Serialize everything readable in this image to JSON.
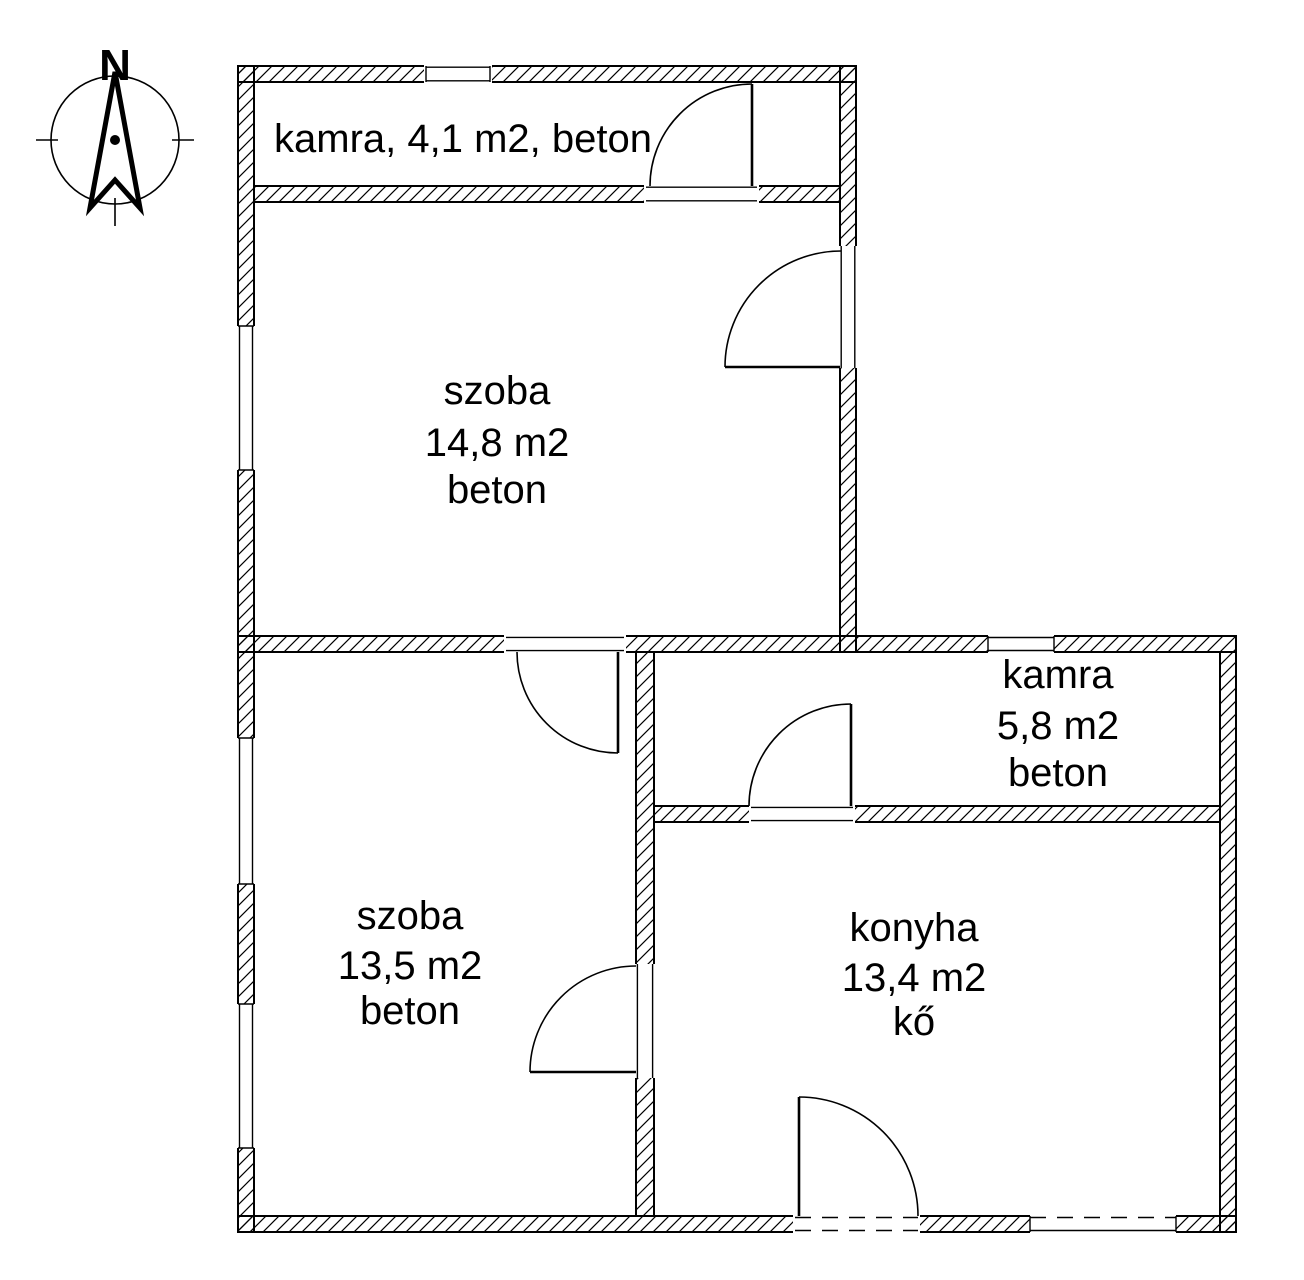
{
  "compass": {
    "north_label": "N"
  },
  "rooms": {
    "kamra_top": {
      "label": "kamra, 4,1 m2, beton"
    },
    "szoba_top": {
      "name": "szoba",
      "area": "14,8 m2",
      "floor": "beton"
    },
    "kamra_right": {
      "name": "kamra",
      "area": "5,8 m2",
      "floor": "beton"
    },
    "szoba_bottom": {
      "name": "szoba",
      "area": "13,5 m2",
      "floor": "beton"
    },
    "konyha": {
      "name": "konyha",
      "area": "13,4 m2",
      "floor": "kő"
    }
  },
  "colors": {
    "line": "#000000",
    "background": "#ffffff"
  }
}
